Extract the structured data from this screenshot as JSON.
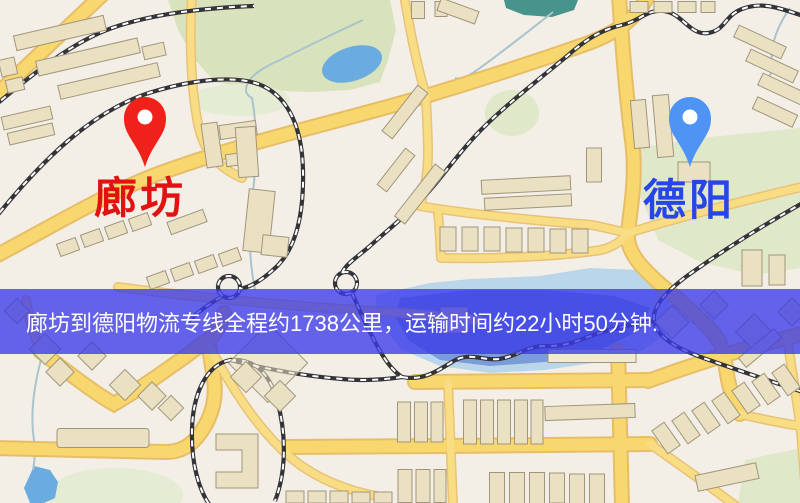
{
  "route": {
    "origin": "廊坊",
    "destination": "德阳",
    "distance": "约1738公里",
    "duration": "约22小时50分钟"
  },
  "banner": {
    "text": "廊坊到德阳物流专线全程约1738公里，运输时间约22小时50分钟.",
    "bg_color": "#3a3ae8",
    "text_color": "#ffffff"
  },
  "markers": {
    "origin_pin_color": "#f0211a",
    "destination_pin_color": "#4f93f5",
    "origin_label_color": "#e31212",
    "destination_label_color": "#2846e8"
  },
  "map_colors": {
    "background": "#f3efe6",
    "road": "#f8d76e",
    "park": "#d8e3bd",
    "water": "#7c9cd8"
  }
}
